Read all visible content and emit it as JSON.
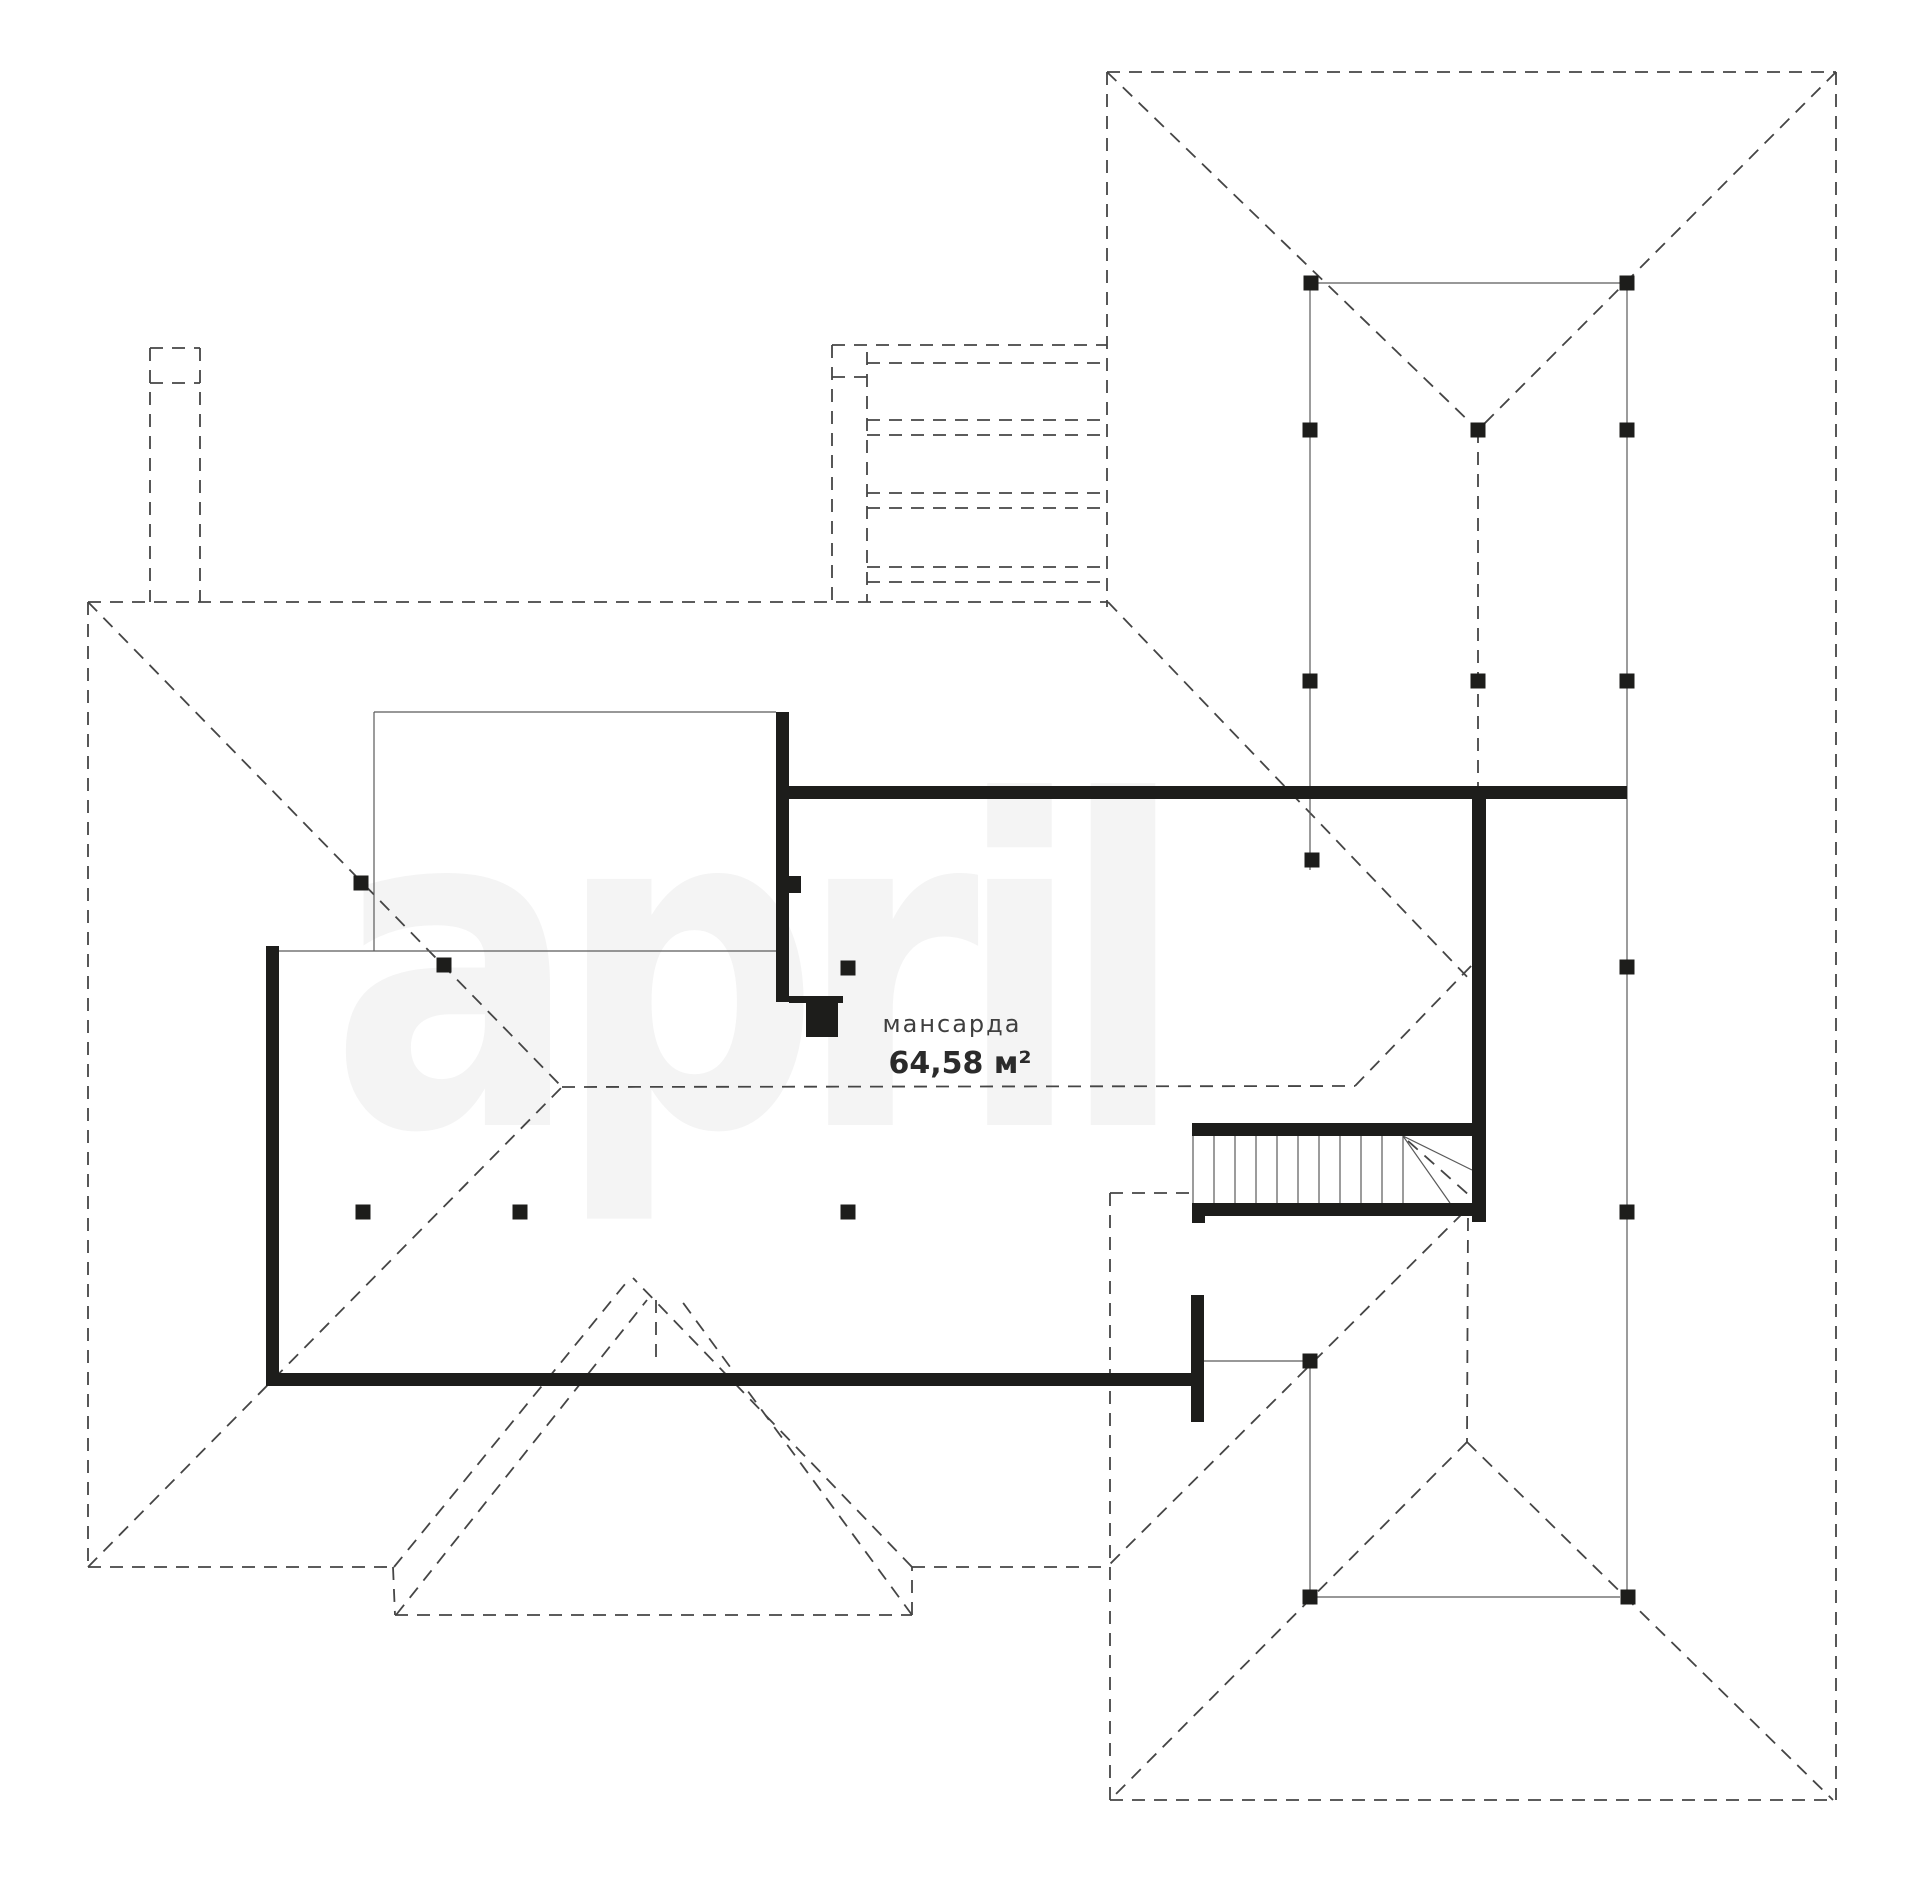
{
  "watermark": {
    "text": "april"
  },
  "room": {
    "name": "мансарда",
    "area": "64,58 м²"
  },
  "colors": {
    "wall": "#1d1d1b",
    "dash": "#454545",
    "thin": "#5a5a5a",
    "label": "#3f3f3f",
    "area": "#2b2b2b",
    "watermark": "#f4f4f4",
    "background": "#ffffff"
  },
  "plan": {
    "width": 1920,
    "height": 1903,
    "dashed_lines": [
      [
        1107,
        72,
        1836,
        72
      ],
      [
        1107,
        72,
        1107,
        607
      ],
      [
        1836,
        72,
        1836,
        1800
      ],
      [
        1107,
        72,
        1478,
        430
      ],
      [
        1836,
        72,
        1478,
        430
      ],
      [
        1478,
        430,
        1478,
        786
      ],
      [
        150,
        348,
        200,
        348
      ],
      [
        150,
        348,
        150,
        602
      ],
      [
        200,
        348,
        200,
        602
      ],
      [
        150,
        383,
        200,
        383
      ],
      [
        832,
        345,
        1107,
        345
      ],
      [
        832,
        345,
        832,
        602
      ],
      [
        867,
        352,
        867,
        602
      ],
      [
        832,
        377,
        867,
        377
      ],
      [
        867,
        363,
        1107,
        363
      ],
      [
        867,
        420,
        1107,
        420
      ],
      [
        867,
        435,
        1107,
        435
      ],
      [
        867,
        493,
        1107,
        493
      ],
      [
        867,
        508,
        1107,
        508
      ],
      [
        867,
        567,
        1107,
        567
      ],
      [
        867,
        582,
        1107,
        582
      ],
      [
        88,
        602,
        1108,
        602
      ],
      [
        88,
        602,
        88,
        1567
      ],
      [
        88,
        1567,
        393,
        1567
      ],
      [
        393,
        1567,
        395,
        1615
      ],
      [
        395,
        1615,
        912,
        1615
      ],
      [
        912,
        1615,
        912,
        1567
      ],
      [
        912,
        1567,
        1110,
        1567
      ],
      [
        88,
        602,
        562,
        1087
      ],
      [
        88,
        1567,
        562,
        1087
      ],
      [
        562,
        1087,
        1355,
        1086
      ],
      [
        1108,
        602,
        1472,
        982
      ],
      [
        1355,
        1086,
        1472,
        965
      ],
      [
        394,
        1567,
        630,
        1278
      ],
      [
        912,
        1567,
        633,
        1278
      ],
      [
        396,
        1615,
        647,
        1300
      ],
      [
        912,
        1615,
        681,
        1300
      ],
      [
        656,
        1300,
        656,
        1358
      ],
      [
        1463,
        1213,
        1110,
        1564
      ],
      [
        1468,
        1218,
        1467,
        1442
      ],
      [
        1467,
        1442,
        1110,
        1800
      ],
      [
        1467,
        1442,
        1833,
        1800
      ],
      [
        1110,
        1193,
        1190,
        1193
      ],
      [
        1110,
        1193,
        1110,
        1800
      ],
      [
        1110,
        1800,
        1836,
        1800
      ],
      [
        1408,
        1141,
        1470,
        1196
      ]
    ],
    "thin_lines": [
      [
        374,
        712,
        776,
        712
      ],
      [
        374,
        712,
        374,
        951
      ],
      [
        278,
        951,
        776,
        951
      ],
      [
        1318,
        283,
        1620,
        283
      ],
      [
        1310,
        290,
        1310,
        870
      ],
      [
        1627,
        290,
        1627,
        1590
      ],
      [
        1204,
        1361,
        1303,
        1361
      ],
      [
        1310,
        1368,
        1310,
        1590
      ],
      [
        1317,
        1597,
        1620,
        1597
      ],
      [
        1403,
        1136,
        1472,
        1170
      ],
      [
        1403,
        1136,
        1450,
        1203
      ]
    ],
    "wall_rects": [
      [
        266,
        946,
        13,
        440
      ],
      [
        266,
        1373,
        925,
        13
      ],
      [
        1191,
        1295,
        13,
        127
      ],
      [
        776,
        712,
        13,
        290
      ],
      [
        789,
        876,
        12,
        17
      ],
      [
        789,
        996,
        54,
        7
      ],
      [
        806,
        1002,
        32,
        35
      ],
      [
        776,
        786,
        851,
        13
      ],
      [
        1472,
        786,
        14,
        350
      ],
      [
        1192,
        1123,
        294,
        13
      ],
      [
        1192,
        1203,
        294,
        13
      ],
      [
        1192,
        1203,
        13,
        20
      ],
      [
        1472,
        1123,
        14,
        99
      ]
    ],
    "stairs": {
      "riser_xs": [
        1193,
        1214,
        1235,
        1256,
        1277,
        1298,
        1319,
        1340,
        1361,
        1382,
        1403
      ],
      "top_y": 1136,
      "bottom_y": 1203
    },
    "posts": [
      [
        1311,
        283
      ],
      [
        1627,
        283
      ],
      [
        1310,
        430
      ],
      [
        1478,
        430
      ],
      [
        1627,
        430
      ],
      [
        1310,
        681
      ],
      [
        1478,
        681
      ],
      [
        1627,
        681
      ],
      [
        1312,
        860
      ],
      [
        361,
        883
      ],
      [
        444,
        965
      ],
      [
        848,
        968
      ],
      [
        1627,
        967
      ],
      [
        363,
        1212
      ],
      [
        520,
        1212
      ],
      [
        848,
        1212
      ],
      [
        1627,
        1212
      ],
      [
        1310,
        1361
      ],
      [
        1310,
        1597
      ],
      [
        1628,
        1597
      ]
    ]
  }
}
